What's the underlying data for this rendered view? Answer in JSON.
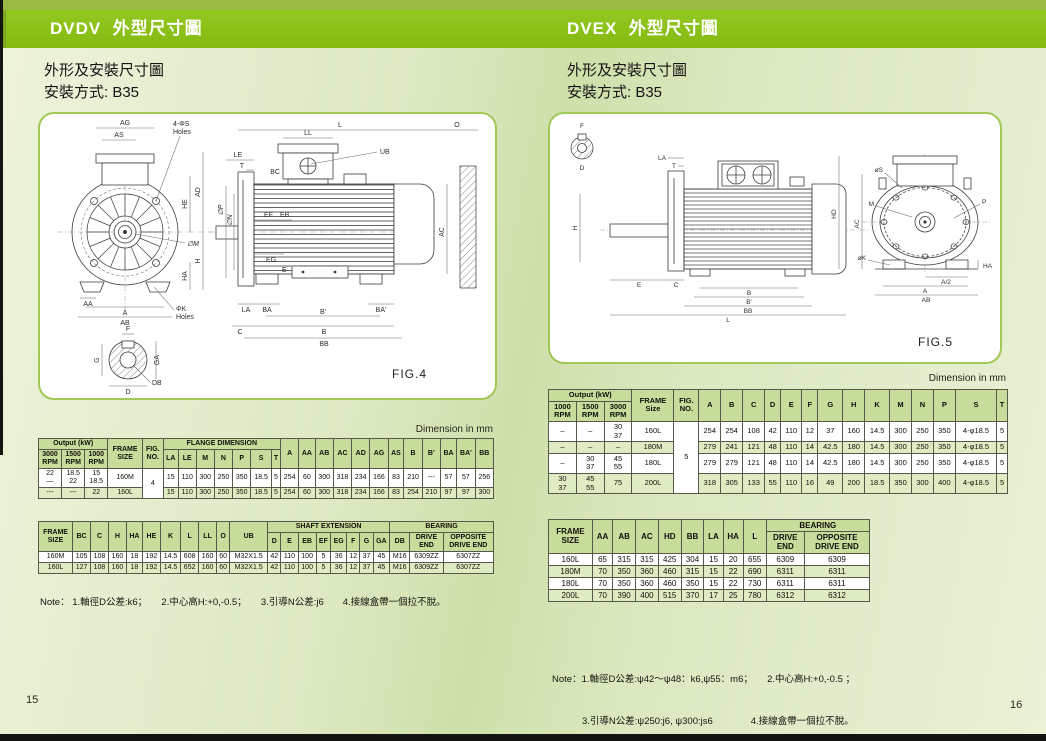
{
  "page_left": {
    "banner": "DVDV  外型尺寸圖",
    "subtitle1": "外形及安裝尺寸圖",
    "subtitle2": "安裝方式: B35",
    "dim_note": "Dimension in mm",
    "page_number": "15",
    "note": "Note： 1.軸徑D公差:k6；　　2.中心高H:+0,-0.5；　　3.引導N公差:j6　　4.接線盒帶一個拉不脫。",
    "fig": {
      "caption": "FIG.4",
      "ag": "AG",
      "as": "AS",
      "s_holes1": "4-ΦS",
      "s_holes2": "Holes",
      "he": "HE",
      "ad": "AD",
      "m": "∅M",
      "ha": "HA",
      "h": "H",
      "aa": "AA",
      "a": "A",
      "ab": "AB",
      "k_holes1": "ΦK",
      "k_holes2": "Holes",
      "l": "L",
      "o": "O",
      "ll": "LL",
      "ub": "UB",
      "bc": "BC",
      "le": "LE",
      "t": "T",
      "ef": "EF",
      "eb": "EB",
      "p": "∅P",
      "n": "∅N",
      "eg": "EG",
      "e": "E",
      "ac": "AC",
      "la": "LA",
      "ba": "BA",
      "ba2": "BA'",
      "b2": "B'",
      "b": "B",
      "bb": "BB",
      "c": "C",
      "f": "F",
      "g": "G",
      "ga": "GA",
      "d": "D",
      "db": "DB"
    },
    "flange_table": {
      "header": [
        [
          {
            "t": "Output (kW)",
            "c": 3
          },
          {
            "t": "FRAME\nSIZE",
            "r": 2
          },
          {
            "t": "FIG.\nNO.",
            "r": 2
          },
          {
            "t": "FLANGE DIMENSION",
            "c": 7
          },
          {
            "t": "A",
            "r": 2
          },
          {
            "t": "AA",
            "r": 2
          },
          {
            "t": "AB",
            "r": 2
          },
          {
            "t": "AC",
            "r": 2
          },
          {
            "t": "AD",
            "r": 2
          },
          {
            "t": "AG",
            "r": 2
          },
          {
            "t": "AS",
            "r": 2
          },
          {
            "t": "B",
            "r": 2
          },
          {
            "t": "B'",
            "r": 2
          },
          {
            "t": "BA",
            "r": 2
          },
          {
            "t": "BA'",
            "r": 2
          },
          {
            "t": "BB",
            "r": 2
          }
        ],
        [
          {
            "t": "3000\nRPM"
          },
          {
            "t": "1500\nRPM"
          },
          {
            "t": "1000\nRPM"
          },
          {
            "t": "LA"
          },
          {
            "t": "LE"
          },
          {
            "t": "M"
          },
          {
            "t": "N"
          },
          {
            "t": "P"
          },
          {
            "t": "S"
          },
          {
            "t": "T"
          }
        ]
      ],
      "rows": [
        {
          "shade": false,
          "cells": [
            {
              "t": "22\n—"
            },
            {
              "t": "18.5\n22"
            },
            {
              "t": "15\n18.5"
            },
            {
              "t": "160M"
            },
            {
              "t": "4",
              "r": 2,
              "white": true
            },
            {
              "t": "15"
            },
            {
              "t": "110"
            },
            {
              "t": "300"
            },
            {
              "t": "250"
            },
            {
              "t": "350"
            },
            {
              "t": "18.5"
            },
            {
              "t": "5"
            },
            {
              "t": "254"
            },
            {
              "t": "60"
            },
            {
              "t": "300"
            },
            {
              "t": "318"
            },
            {
              "t": "234"
            },
            {
              "t": "166"
            },
            {
              "t": "83"
            },
            {
              "t": "210"
            },
            {
              "t": "---"
            },
            {
              "t": "57"
            },
            {
              "t": "57"
            },
            {
              "t": "256"
            }
          ]
        },
        {
          "shade": true,
          "cells": [
            {
              "t": "---"
            },
            {
              "t": "---"
            },
            {
              "t": "22"
            },
            {
              "t": "160L"
            },
            {
              "t": "15"
            },
            {
              "t": "110"
            },
            {
              "t": "300"
            },
            {
              "t": "250"
            },
            {
              "t": "350"
            },
            {
              "t": "18.5"
            },
            {
              "t": "5"
            },
            {
              "t": "254"
            },
            {
              "t": "60"
            },
            {
              "t": "300"
            },
            {
              "t": "318"
            },
            {
              "t": "234"
            },
            {
              "t": "166"
            },
            {
              "t": "83"
            },
            {
              "t": "254"
            },
            {
              "t": "210"
            },
            {
              "t": "97"
            },
            {
              "t": "97"
            },
            {
              "t": "300"
            }
          ]
        }
      ]
    },
    "shaft_table": {
      "header": [
        [
          {
            "t": "FRAME\nSIZE",
            "r": 2
          },
          {
            "t": "BC",
            "r": 2
          },
          {
            "t": "C",
            "r": 2
          },
          {
            "t": "H",
            "r": 2
          },
          {
            "t": "HA",
            "r": 2
          },
          {
            "t": "HE",
            "r": 2
          },
          {
            "t": "K",
            "r": 2
          },
          {
            "t": "L",
            "r": 2
          },
          {
            "t": "LL",
            "r": 2
          },
          {
            "t": "O",
            "r": 2
          },
          {
            "t": "UB",
            "r": 2
          },
          {
            "t": "SHAFT  EXTENSION",
            "c": 8
          },
          {
            "t": "BEARING",
            "c": 3
          }
        ],
        [
          {
            "t": "D"
          },
          {
            "t": "E"
          },
          {
            "t": "EB"
          },
          {
            "t": "EF"
          },
          {
            "t": "EG"
          },
          {
            "t": "F"
          },
          {
            "t": "G"
          },
          {
            "t": "GA"
          },
          {
            "t": "DB"
          },
          {
            "t": "DRIVE\nEND"
          },
          {
            "t": "OPPOSITE\nDRIVE  END"
          }
        ]
      ],
      "rows": [
        {
          "shade": false,
          "cells": [
            {
              "t": "160M"
            },
            {
              "t": "105"
            },
            {
              "t": "108"
            },
            {
              "t": "160"
            },
            {
              "t": "18"
            },
            {
              "t": "192"
            },
            {
              "t": "14.5"
            },
            {
              "t": "608"
            },
            {
              "t": "160"
            },
            {
              "t": "60"
            },
            {
              "t": "M32X1.5"
            },
            {
              "t": "42"
            },
            {
              "t": "110"
            },
            {
              "t": "100"
            },
            {
              "t": "5"
            },
            {
              "t": "36"
            },
            {
              "t": "12"
            },
            {
              "t": "37"
            },
            {
              "t": "45"
            },
            {
              "t": "M16"
            },
            {
              "t": "6309ZZ"
            },
            {
              "t": "6307ZZ"
            }
          ]
        },
        {
          "shade": true,
          "cells": [
            {
              "t": "160L"
            },
            {
              "t": "127"
            },
            {
              "t": "108"
            },
            {
              "t": "160"
            },
            {
              "t": "18"
            },
            {
              "t": "192"
            },
            {
              "t": "14.5"
            },
            {
              "t": "652"
            },
            {
              "t": "160"
            },
            {
              "t": "60"
            },
            {
              "t": "M32X1.5"
            },
            {
              "t": "42"
            },
            {
              "t": "110"
            },
            {
              "t": "100"
            },
            {
              "t": "5"
            },
            {
              "t": "36"
            },
            {
              "t": "12"
            },
            {
              "t": "37"
            },
            {
              "t": "45"
            },
            {
              "t": "M16"
            },
            {
              "t": "6309ZZ"
            },
            {
              "t": "6307ZZ"
            }
          ]
        }
      ]
    }
  },
  "page_right": {
    "banner": "DVEX  外型尺寸圖",
    "subtitle1": "外形及安裝尺寸圖",
    "subtitle2": "安裝方式: B35",
    "dim_note": "Dimension in mm",
    "page_number": "16",
    "note_line1": "Note：1.軸徑D公差:ψ42～ψ48：k6,ψ55：m6；　　2.中心高H:+0,-0.5 ；",
    "note_line2": "3.引導N公差:ψ250:j6, ψ300:js6　　　　4.接線盒帶一個拉不脫。",
    "fig": {
      "caption": "FIG.5",
      "f": "F",
      "d": "D",
      "h": "H",
      "la": "LA",
      "t": "T",
      "e": "E",
      "c": "C",
      "b": "B",
      "b2": "B'",
      "bb": "BB",
      "l": "L",
      "hd": "HD",
      "ac": "AC",
      "s": "øS",
      "m": "M",
      "p": "P",
      "k": "øK",
      "a2": "A/2",
      "ha": "HA",
      "a": "A",
      "ab": "AB"
    },
    "dim_table": {
      "header": [
        [
          {
            "t": "Output (kW)",
            "c": 3
          },
          {
            "t": "FRAME\nSize",
            "r": 2
          },
          {
            "t": "FIG.\nNO.",
            "r": 2
          },
          {
            "t": "A",
            "r": 2
          },
          {
            "t": "B",
            "r": 2
          },
          {
            "t": "C",
            "r": 2
          },
          {
            "t": "D",
            "r": 2
          },
          {
            "t": "E",
            "r": 2
          },
          {
            "t": "F",
            "r": 2
          },
          {
            "t": "G",
            "r": 2
          },
          {
            "t": "H",
            "r": 2
          },
          {
            "t": "K",
            "r": 2
          },
          {
            "t": "M",
            "r": 2
          },
          {
            "t": "N",
            "r": 2
          },
          {
            "t": "P",
            "r": 2
          },
          {
            "t": "S",
            "r": 2
          },
          {
            "t": "T",
            "r": 2
          }
        ],
        [
          {
            "t": "1000\nRPM"
          },
          {
            "t": "1500\nRPM"
          },
          {
            "t": "3000\nRPM"
          }
        ]
      ],
      "rows": [
        {
          "shade": false,
          "cells": [
            {
              "t": "–"
            },
            {
              "t": "–"
            },
            {
              "t": "30\n37"
            },
            {
              "t": "160L"
            },
            {
              "t": "5",
              "r": 4,
              "white": true
            },
            {
              "t": "254"
            },
            {
              "t": "254"
            },
            {
              "t": "108"
            },
            {
              "t": "42"
            },
            {
              "t": "110"
            },
            {
              "t": "12"
            },
            {
              "t": "37"
            },
            {
              "t": "160"
            },
            {
              "t": "14.5"
            },
            {
              "t": "300"
            },
            {
              "t": "250"
            },
            {
              "t": "350"
            },
            {
              "t": "4-φ18.5"
            },
            {
              "t": "5"
            }
          ]
        },
        {
          "shade": true,
          "cells": [
            {
              "t": "–"
            },
            {
              "t": "–"
            },
            {
              "t": "–"
            },
            {
              "t": "180M"
            },
            {
              "t": "279"
            },
            {
              "t": "241"
            },
            {
              "t": "121"
            },
            {
              "t": "48"
            },
            {
              "t": "110"
            },
            {
              "t": "14"
            },
            {
              "t": "42.5"
            },
            {
              "t": "180"
            },
            {
              "t": "14.5"
            },
            {
              "t": "300"
            },
            {
              "t": "250"
            },
            {
              "t": "350"
            },
            {
              "t": "4-φ18.5"
            },
            {
              "t": "5"
            }
          ]
        },
        {
          "shade": false,
          "cells": [
            {
              "t": "–"
            },
            {
              "t": "30\n37"
            },
            {
              "t": "45\n55"
            },
            {
              "t": "180L"
            },
            {
              "t": "279"
            },
            {
              "t": "279"
            },
            {
              "t": "121"
            },
            {
              "t": "48"
            },
            {
              "t": "110"
            },
            {
              "t": "14"
            },
            {
              "t": "42.5"
            },
            {
              "t": "180"
            },
            {
              "t": "14.5"
            },
            {
              "t": "300"
            },
            {
              "t": "250"
            },
            {
              "t": "350"
            },
            {
              "t": "4-φ18.5"
            },
            {
              "t": "5"
            }
          ]
        },
        {
          "shade": true,
          "cells": [
            {
              "t": "30\n37"
            },
            {
              "t": "45\n55"
            },
            {
              "t": "75"
            },
            {
              "t": "200L"
            },
            {
              "t": "318"
            },
            {
              "t": "305"
            },
            {
              "t": "133"
            },
            {
              "t": "55"
            },
            {
              "t": "110"
            },
            {
              "t": "16"
            },
            {
              "t": "49"
            },
            {
              "t": "200"
            },
            {
              "t": "18.5"
            },
            {
              "t": "350"
            },
            {
              "t": "300"
            },
            {
              "t": "400"
            },
            {
              "t": "4-φ18.5"
            },
            {
              "t": "5"
            }
          ]
        }
      ]
    },
    "bearing_table": {
      "header": [
        [
          {
            "t": "FRAME\nSIZE",
            "r": 2
          },
          {
            "t": "AA",
            "r": 2
          },
          {
            "t": "AB",
            "r": 2
          },
          {
            "t": "AC",
            "r": 2
          },
          {
            "t": "HD",
            "r": 2
          },
          {
            "t": "BB",
            "r": 2
          },
          {
            "t": "LA",
            "r": 2
          },
          {
            "t": "HA",
            "r": 2
          },
          {
            "t": "L",
            "r": 2
          },
          {
            "t": "BEARING",
            "c": 2
          }
        ],
        [
          {
            "t": "DRIVE\nEND"
          },
          {
            "t": "OPPOSITE\nDRIVE END"
          }
        ]
      ],
      "rows": [
        {
          "shade": false,
          "cells": [
            {
              "t": "160L"
            },
            {
              "t": "65"
            },
            {
              "t": "315"
            },
            {
              "t": "315"
            },
            {
              "t": "425"
            },
            {
              "t": "304"
            },
            {
              "t": "15"
            },
            {
              "t": "20"
            },
            {
              "t": "655"
            },
            {
              "t": "6309"
            },
            {
              "t": "6309"
            }
          ]
        },
        {
          "shade": true,
          "cells": [
            {
              "t": "180M"
            },
            {
              "t": "70"
            },
            {
              "t": "350"
            },
            {
              "t": "360"
            },
            {
              "t": "460"
            },
            {
              "t": "315"
            },
            {
              "t": "15"
            },
            {
              "t": "22"
            },
            {
              "t": "690"
            },
            {
              "t": "6311"
            },
            {
              "t": "6311"
            }
          ]
        },
        {
          "shade": false,
          "cells": [
            {
              "t": "180L"
            },
            {
              "t": "70"
            },
            {
              "t": "350"
            },
            {
              "t": "360"
            },
            {
              "t": "460"
            },
            {
              "t": "350"
            },
            {
              "t": "15"
            },
            {
              "t": "22"
            },
            {
              "t": "730"
            },
            {
              "t": "6311"
            },
            {
              "t": "6311"
            }
          ]
        },
        {
          "shade": true,
          "cells": [
            {
              "t": "200L"
            },
            {
              "t": "70"
            },
            {
              "t": "390"
            },
            {
              "t": "400"
            },
            {
              "t": "515"
            },
            {
              "t": "370"
            },
            {
              "t": "17"
            },
            {
              "t": "25"
            },
            {
              "t": "780"
            },
            {
              "t": "6312"
            },
            {
              "t": "6312"
            }
          ]
        }
      ]
    }
  }
}
